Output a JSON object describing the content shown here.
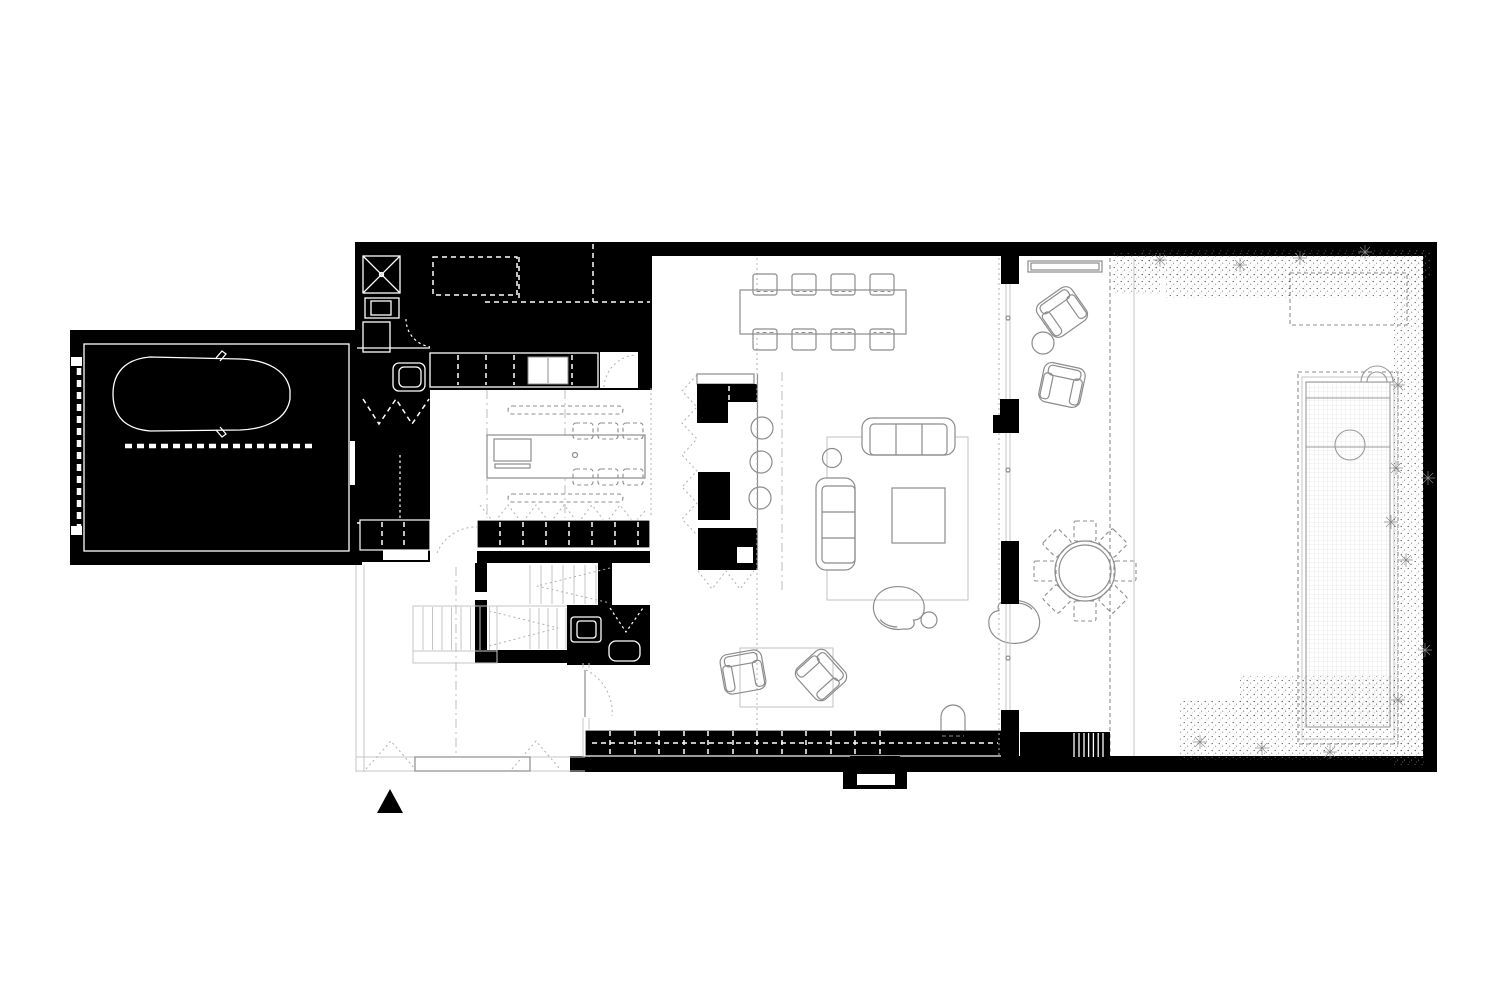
{
  "document": {
    "kind": "architectural-floor-plan",
    "style": "black-and-white poché ground floor plan, no text labels"
  },
  "colors": {
    "walls": "#000000",
    "bg": "#ffffff",
    "furniture": "#8c8c8c",
    "faint": "#c6c6c6"
  },
  "plan": {
    "rooms": [
      "garage",
      "utility-laundry",
      "wardrobe-pantry",
      "kitchen",
      "dining-area",
      "living-area",
      "reading-corner",
      "entry-hall",
      "wc",
      "staircase",
      "covered-porch",
      "terrace-garden",
      "pool"
    ],
    "furniture": [
      "car",
      "washing-machine",
      "laundry-shaft",
      "kitchen-island-with-sink",
      "six-bar-stools",
      "dining-table-with-eight-chairs",
      "bar-counter-with-three-stools",
      "two-sofas",
      "coffee-table",
      "two-swivel-armchairs",
      "side-tables",
      "two-reading-armchairs",
      "rug",
      "wc-sink",
      "toilet",
      "porch-bench",
      "two-porch-lounge-chairs",
      "porch-side-table",
      "round-outdoor-table-with-eight-chairs",
      "wood-stove",
      "planter-bed"
    ],
    "symbols": [
      "north-arrow",
      "door-swing-arcs",
      "stair-direction-arrows",
      "garage-door-dashed-line",
      "vegetation-stipple",
      "pool-tile-grid",
      "wall-cabinet-dashed-divisions"
    ]
  }
}
